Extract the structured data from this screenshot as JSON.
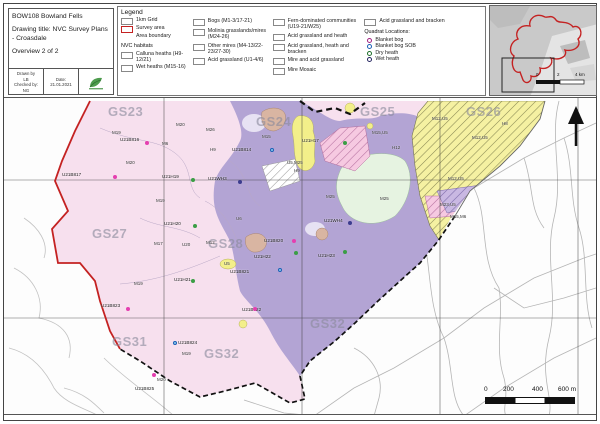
{
  "title_block": {
    "project": "BOW108 Bowland Fells",
    "drawing_title": "Drawing title: NVC Survey Plans - Croasdale",
    "overview": "Overview 2 of 2",
    "drawn_by_label": "Drawn by",
    "drawn_by": "LB",
    "checked_by_label": "Checked by:",
    "checked_by": "NG",
    "date_label": "Date:",
    "date": "21.01.2021"
  },
  "legend": {
    "title": "Legend",
    "col1": [
      {
        "label": "1km Grid",
        "swatch": "sw-grid"
      },
      {
        "label": "Survey area",
        "swatch": "sw-survey"
      },
      {
        "label": "Area boundary",
        "swatch": "sw-boundary"
      }
    ],
    "nvc_header": "NVC habitats",
    "col1b": [
      {
        "label": "Calluna heaths (H9-12/21)",
        "swatch": "sw-purple"
      },
      {
        "label": "Wet heaths (M15-16)",
        "swatch": "sw-lavender"
      }
    ],
    "col2": [
      {
        "label": "Bogs (M1-3/17-21)",
        "swatch": "sw-pink"
      },
      {
        "label": "Molinia grasslands/mires (M24-26)",
        "swatch": "sw-green"
      },
      {
        "label": "Other mires (M4-13/22-23/27-30)",
        "swatch": "sw-pink2"
      },
      {
        "label": "Acid grassland (U1-4/6)",
        "swatch": "sw-yellow"
      }
    ],
    "col3": [
      {
        "label": "Fern-dominated communities (U19-21/W25)",
        "swatch": "sw-tan"
      },
      {
        "label": "Acid grassland and heath",
        "swatch": "sw-hatch-yellow"
      },
      {
        "label": "Acid grassland, heath and bracken",
        "swatch": "sw-hatch-yellow2"
      },
      {
        "label": "Mire and acid grassland",
        "swatch": "sw-hatch-white"
      },
      {
        "label": "Mire Mosaic",
        "swatch": "sw-hatch-pink"
      }
    ],
    "col4": [
      {
        "label": "Acid grassland and bracken",
        "swatch": "sw-hatch-tan"
      }
    ],
    "quadrat_header": "Quadrat Locations:",
    "quadrats": [
      {
        "label": "Blanket bog",
        "swatch": "dot dot-magenta"
      },
      {
        "label": "Blanket bog SOB",
        "swatch": "dot dot-blue"
      },
      {
        "label": "Dry heath",
        "swatch": "dot dot-green"
      },
      {
        "label": "Wet heath",
        "swatch": "dot dot-navy"
      }
    ]
  },
  "inset": {
    "scale_labels": [
      {
        "text": "0",
        "x": 46,
        "y": 66
      },
      {
        "text": "2",
        "x": 67,
        "y": 66
      },
      {
        "text": "4 km",
        "x": 85,
        "y": 66
      }
    ]
  },
  "map": {
    "grid_labels": [
      {
        "text": "GS23",
        "x": 104,
        "y": 6
      },
      {
        "text": "GS24",
        "x": 252,
        "y": 16
      },
      {
        "text": "GS25",
        "x": 356,
        "y": 6
      },
      {
        "text": "GS26",
        "x": 462,
        "y": 6
      },
      {
        "text": "GS27",
        "x": 88,
        "y": 128
      },
      {
        "text": "GS28",
        "x": 204,
        "y": 138
      },
      {
        "text": "GS31",
        "x": 108,
        "y": 236
      },
      {
        "text": "GS32",
        "x": 200,
        "y": 248
      },
      {
        "text": "GS32",
        "x": 306,
        "y": 218
      }
    ],
    "quadrat_markers": [
      {
        "label": "U21B816",
        "x": 116,
        "y": 30,
        "dot": "qd-magenta",
        "dx": 25,
        "dy": 13
      },
      {
        "label": "U21B817",
        "x": 58,
        "y": 65,
        "dot": "qd-magenta",
        "dx": 51,
        "dy": 12
      },
      {
        "label": "U21H19",
        "x": 158,
        "y": 67,
        "dot": "qd-green",
        "dx": 29,
        "dy": 13
      },
      {
        "label": "U21WH3",
        "x": 204,
        "y": 69,
        "dot": "qd-navy",
        "dx": 30,
        "dy": 13
      },
      {
        "label": "U21B814",
        "x": 228,
        "y": 40,
        "dot": "qd-blue",
        "dx": 38,
        "dy": 10
      },
      {
        "label": "U21H17",
        "x": 298,
        "y": 31,
        "dot": "qd-green",
        "dx": 41,
        "dy": 12
      },
      {
        "label": "U21WH4",
        "x": 320,
        "y": 111,
        "dot": "qd-navy",
        "dx": 24,
        "dy": 12
      },
      {
        "label": "U21H20",
        "x": 160,
        "y": 114,
        "dot": "qd-green",
        "dx": 29,
        "dy": 12
      },
      {
        "label": "U21B820",
        "x": 260,
        "y": 131,
        "dot": "qd-magenta",
        "dx": 28,
        "dy": 10
      },
      {
        "label": "U21H22",
        "x": 250,
        "y": 147,
        "dot": "qd-green",
        "dx": 40,
        "dy": 6
      },
      {
        "label": "U21H23",
        "x": 314,
        "y": 146,
        "dot": "qd-green",
        "dx": 25,
        "dy": 6
      },
      {
        "label": "U21B821",
        "x": 226,
        "y": 162,
        "dot": "qd-blue",
        "dx": 48,
        "dy": 8
      },
      {
        "label": "U21H21",
        "x": 170,
        "y": 170,
        "dot": "qd-green",
        "dx": 17,
        "dy": 11
      },
      {
        "label": "U21B823",
        "x": 97,
        "y": 196,
        "dot": "qd-magenta",
        "dx": 25,
        "dy": 13
      },
      {
        "label": "U21B822",
        "x": 238,
        "y": 200,
        "dot": "qd-magenta",
        "dx": 11,
        "dy": 9
      },
      {
        "label": "U21B824",
        "x": 174,
        "y": 233,
        "dot": "qd-blue",
        "dx": -5,
        "dy": 10
      },
      {
        "label": "U21B825",
        "x": 131,
        "y": 279,
        "dot": "qd-magenta",
        "dx": 17,
        "dy": -4
      }
    ],
    "area_labels": [
      {
        "text": "M19",
        "x": 108,
        "y": 32
      },
      {
        "text": "M20",
        "x": 172,
        "y": 24
      },
      {
        "text": "M6",
        "x": 158,
        "y": 43
      },
      {
        "text": "M26",
        "x": 202,
        "y": 29
      },
      {
        "text": "H9",
        "x": 206,
        "y": 49
      },
      {
        "text": "M20",
        "x": 122,
        "y": 62
      },
      {
        "text": "M15",
        "x": 258,
        "y": 36
      },
      {
        "text": "U5,M25",
        "x": 283,
        "y": 62
      },
      {
        "text": "H9",
        "x": 290,
        "y": 70
      },
      {
        "text": "M19",
        "x": 152,
        "y": 100
      },
      {
        "text": "M17",
        "x": 150,
        "y": 143
      },
      {
        "text": "U20",
        "x": 178,
        "y": 144
      },
      {
        "text": "M12",
        "x": 202,
        "y": 142
      },
      {
        "text": "U6",
        "x": 232,
        "y": 118
      },
      {
        "text": "M15,U5",
        "x": 368,
        "y": 32
      },
      {
        "text": "H12",
        "x": 388,
        "y": 47
      },
      {
        "text": "M25",
        "x": 376,
        "y": 98
      },
      {
        "text": "M25",
        "x": 322,
        "y": 96
      },
      {
        "text": "M12,U5",
        "x": 428,
        "y": 18
      },
      {
        "text": "M12,U5",
        "x": 468,
        "y": 37
      },
      {
        "text": "M12,U5",
        "x": 444,
        "y": 78
      },
      {
        "text": "M23,U5",
        "x": 436,
        "y": 104
      },
      {
        "text": "M15,M6",
        "x": 446,
        "y": 116
      },
      {
        "text": "H8",
        "x": 498,
        "y": 23
      },
      {
        "text": "U5",
        "x": 220,
        "y": 163
      },
      {
        "text": "M19",
        "x": 130,
        "y": 183
      },
      {
        "text": "M19",
        "x": 178,
        "y": 253
      },
      {
        "text": "M20",
        "x": 153,
        "y": 279
      }
    ],
    "scalebar_labels": [
      {
        "text": "0",
        "x": 480,
        "y": 288
      },
      {
        "text": "200",
        "x": 499,
        "y": 288
      },
      {
        "text": "400",
        "x": 528,
        "y": 288
      },
      {
        "text": "600 m",
        "x": 554,
        "y": 288
      }
    ]
  }
}
